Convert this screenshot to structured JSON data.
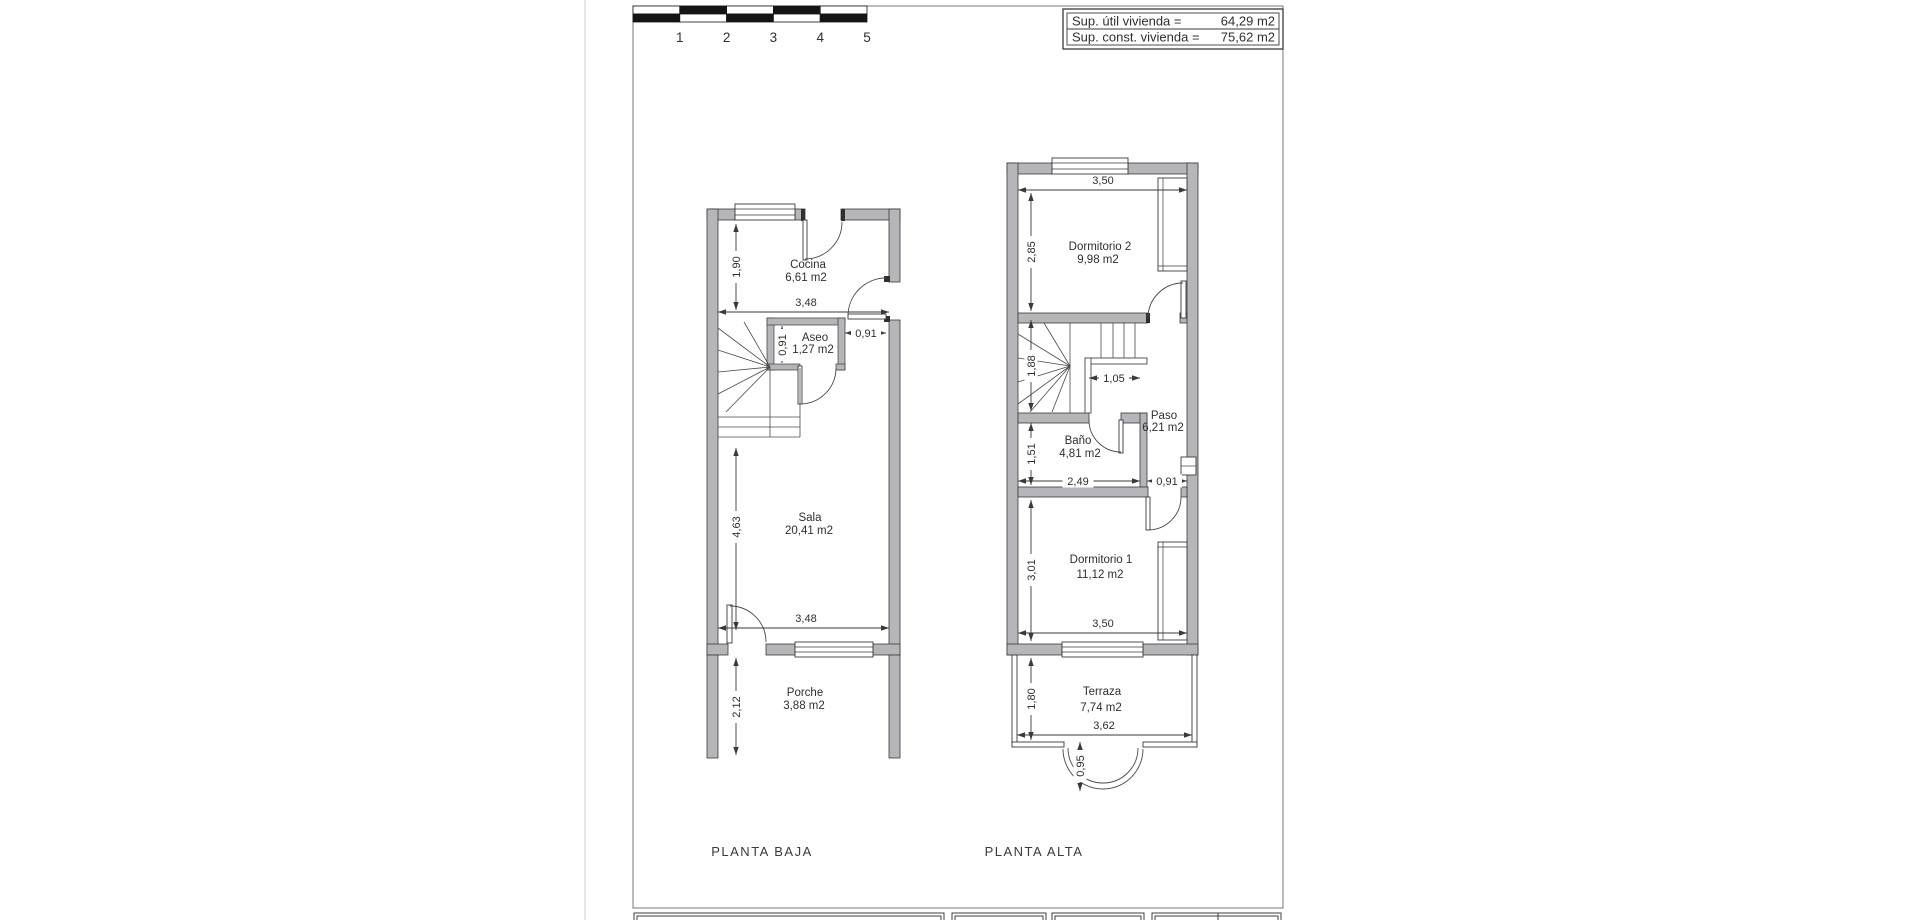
{
  "page": {
    "colors": {
      "wall_fill": "#b6b6ba",
      "line": "#3a3a3a"
    },
    "scale_bar": {
      "numbers": [
        "1",
        "2",
        "3",
        "4",
        "5"
      ]
    },
    "title_block": {
      "rows": [
        {
          "label": "Sup. útil vivienda =",
          "value": "64,29 m2"
        },
        {
          "label": "Sup. const. vivienda =",
          "value": "75,62 m2"
        }
      ]
    }
  },
  "baja": {
    "title": "PLANTA BAJA",
    "rooms": {
      "cocina": {
        "name": "Cocina",
        "area": "6,61 m2"
      },
      "aseo": {
        "name": "Aseo",
        "area": "1,27 m2"
      },
      "sala": {
        "name": "Sala",
        "area": "20,41 m2"
      },
      "porche": {
        "name": "Porche",
        "area": "3,88 m2"
      }
    },
    "dims": {
      "cocina_height": "1,90",
      "cocina_width": "3,48",
      "aseo_height": "0,91",
      "entry_door_width": "0,91",
      "sala_height": "4,63",
      "sala_width": "3,48",
      "porche_height": "2,12"
    }
  },
  "alta": {
    "title": "PLANTA ALTA",
    "rooms": {
      "dorm2": {
        "name": "Dormitorio 2",
        "area": "9,98 m2"
      },
      "paso": {
        "name": "Paso",
        "area": "6,21 m2"
      },
      "bano": {
        "name": "Baño",
        "area": "4,81 m2"
      },
      "dorm1": {
        "name": "Dormitorio 1",
        "area": "11,12 m2"
      },
      "terraza": {
        "name": "Terraza",
        "area": "7,74 m2"
      }
    },
    "dims": {
      "dorm2_width": "3,50",
      "dorm2_height": "2,85",
      "stair_height": "1,88",
      "landing_width": "1,05",
      "bano_height": "1,51",
      "bano_width": "2,49",
      "dorm1_door_width": "0,91",
      "dorm1_height": "3,01",
      "dorm1_width": "3,50",
      "terraza_height": "1,80",
      "terraza_width": "3,62",
      "bay_depth": "0,95"
    }
  }
}
